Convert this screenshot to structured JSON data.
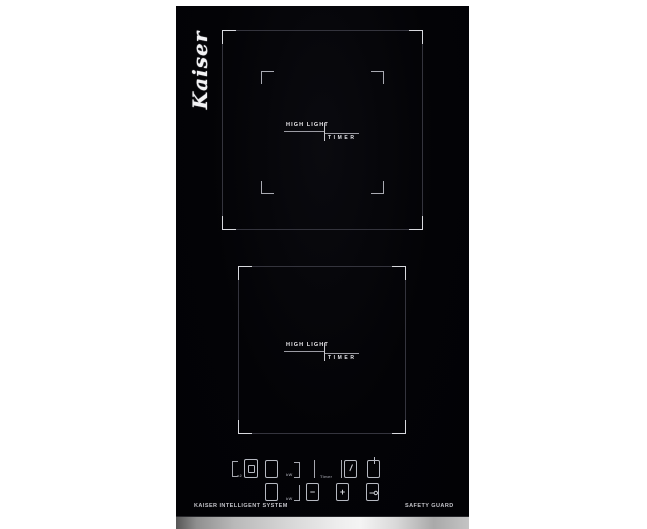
{
  "product": {
    "brand": "Kaiser"
  },
  "zones": {
    "upper": {
      "line1": "HIGH LIGHT",
      "line2": "TIMER"
    },
    "lower": {
      "line1": "HIGH LIGHT",
      "line2": "TIMER"
    }
  },
  "controls": {
    "dual_label": "x2",
    "kw_top": "kW",
    "kw_bottom": "kW",
    "timer_label": "Timer",
    "minus": "−",
    "plus": "+"
  },
  "footer": {
    "left": "KAISER INTELLIGENT SYSTEM",
    "right": "SAFETY GUARD"
  },
  "colors": {
    "glass": "#040407",
    "outline_line": "#34343d",
    "corner_accent": "#d8d9de",
    "zone_text": "#eceaee",
    "control_line": "#b6b9c1",
    "metal_light": "#f4f4f4",
    "metal_dark": "#565656"
  }
}
